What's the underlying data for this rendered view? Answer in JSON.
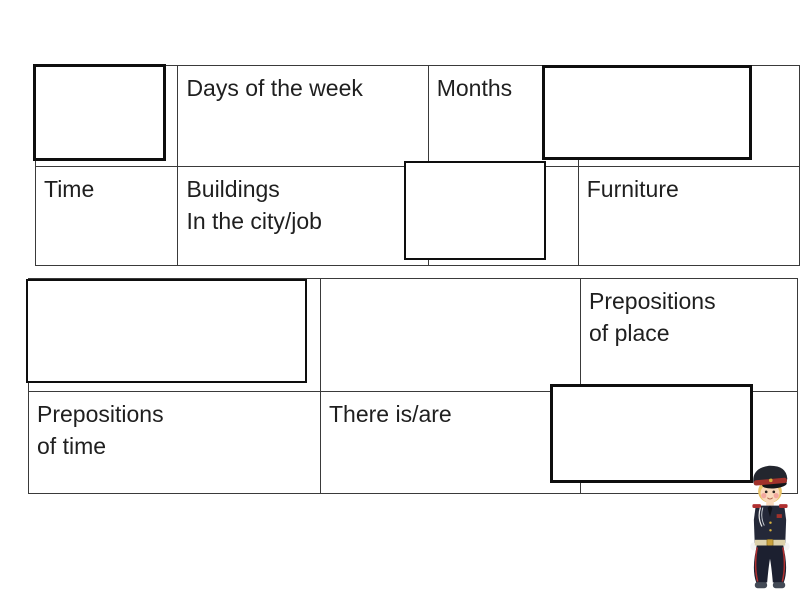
{
  "table1": {
    "row1": {
      "blank_left": "",
      "days_of_week": "Days of the week",
      "months": "Months",
      "blank_right": ""
    },
    "row2": {
      "time": "Time",
      "buildings": "Buildings\nIn the city/job",
      "blank_middle": "",
      "furniture": "Furniture"
    }
  },
  "table2": {
    "row1": {
      "blank_left": "",
      "blank_middle": "",
      "prepositions_of_place": "Prepositions\nof place"
    },
    "row2": {
      "prepositions_of_time": "Prepositions\nof time",
      "there_is_are": "There is/are",
      "blank_right": ""
    }
  },
  "covers": {
    "count": 5,
    "fill": "#ffffff",
    "border_color": "#0e0e0e"
  },
  "mascot": {
    "icon": "cadet-boy-mascot",
    "uniform_color": "#242838",
    "accent_color": "#a1312b"
  },
  "colors": {
    "background": "#ffffff",
    "grid_border": "#3a3a3a",
    "text": "#1f1f1f"
  }
}
